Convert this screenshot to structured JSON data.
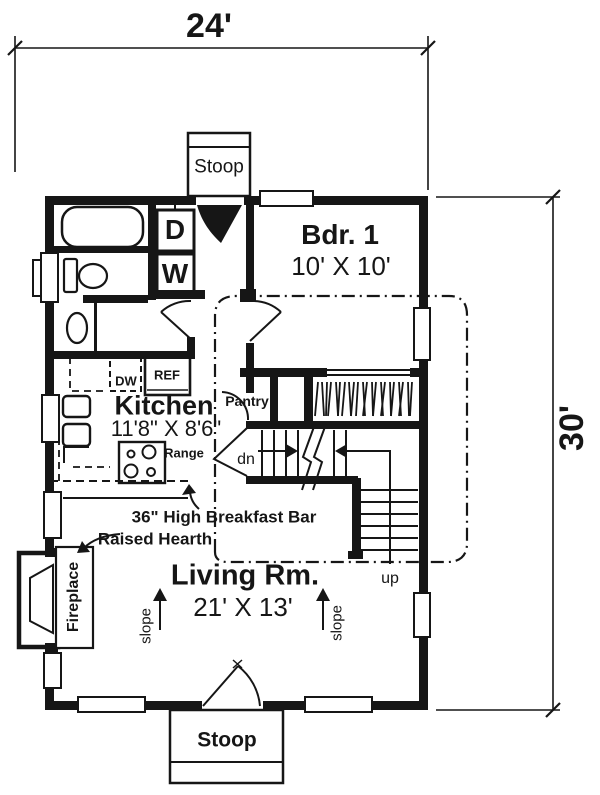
{
  "dimensions": {
    "width": "24'",
    "height": "30'"
  },
  "stoop_top": "Stoop",
  "stoop_bottom": "Stoop",
  "rooms": {
    "bedroom": {
      "name": "Bdr. 1",
      "size": "10' X 10'"
    },
    "kitchen": {
      "name": "Kitchen",
      "size": "11'8\" X 8'6\""
    },
    "living": {
      "name": "Living Rm.",
      "size": "21' X 13'"
    },
    "pantry": {
      "name": "Pantry"
    }
  },
  "appliances": {
    "dryer": "D",
    "washer": "W",
    "dishwasher": "DW",
    "refrigerator": "REF",
    "range": "Range"
  },
  "stairs": {
    "down": "dn",
    "up": "up"
  },
  "annotations": {
    "breakfast_bar": "36\" High Breakfast Bar",
    "raised_hearth": "Raised Hearth",
    "fireplace": "Fireplace",
    "slope_left": "slope",
    "slope_right": "slope"
  },
  "colors": {
    "ink": "#161616",
    "paper": "#ffffff"
  }
}
